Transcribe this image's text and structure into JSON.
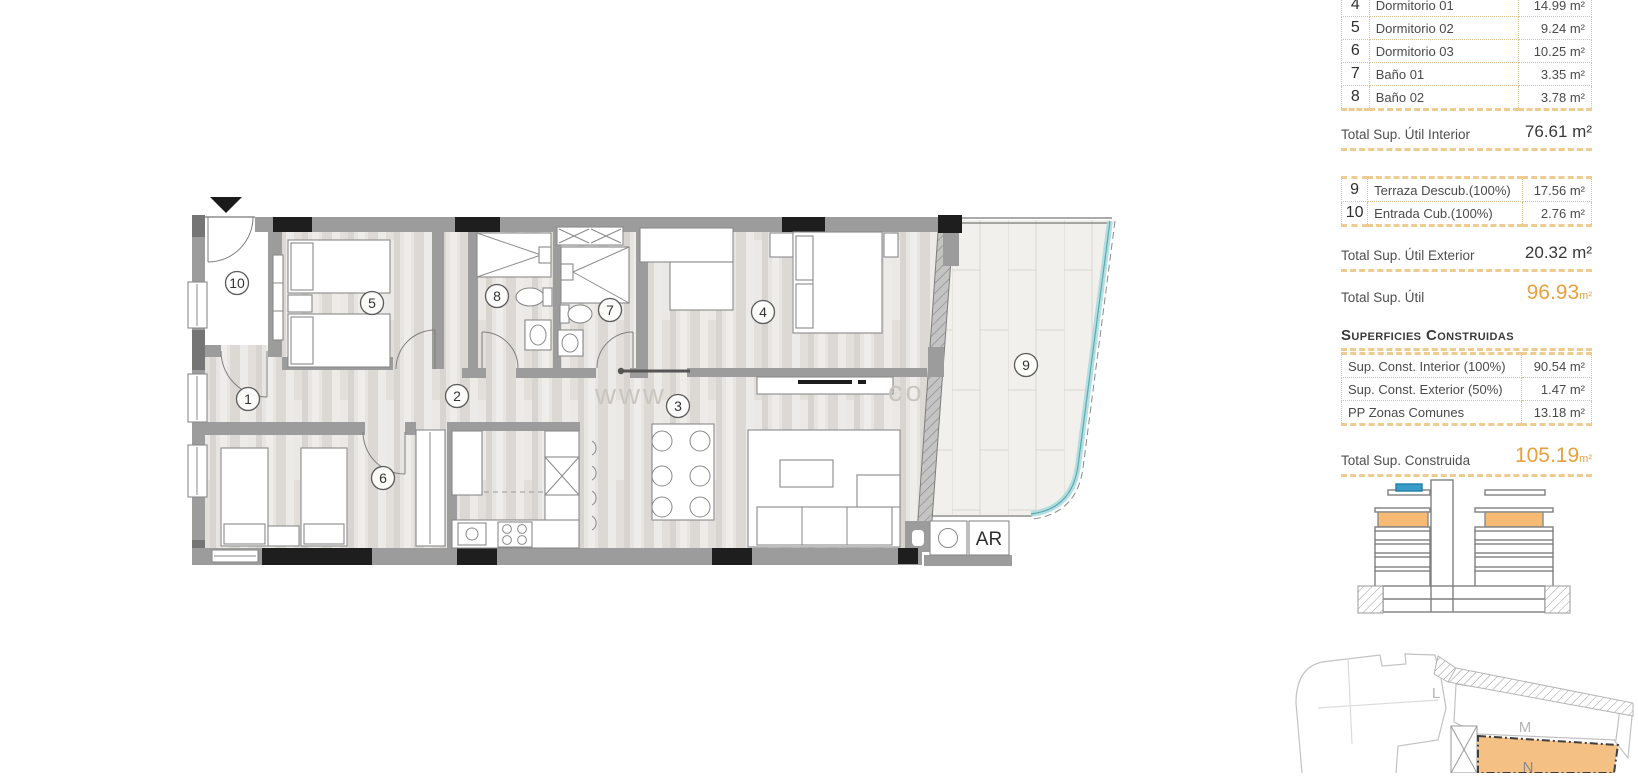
{
  "colors": {
    "accent_orange": "#E8A13E",
    "dash_orange": "#EECB91",
    "table_border": "#DDC28F",
    "wall_gray": "#9C9C9C",
    "pillar_black": "#1E1E1E",
    "glass_teal": "#A8DADE",
    "highlight_orange_fill": "#F5C083",
    "elevation_blue": "#3A9CC9"
  },
  "panel": {
    "interior_rooms": [
      {
        "num": "4",
        "label": "Dormitorio 01",
        "value": "14.99 m²"
      },
      {
        "num": "5",
        "label": "Dormitorio 02",
        "value": "9.24 m²"
      },
      {
        "num": "6",
        "label": "Dormitorio 03",
        "value": "10.25 m²"
      },
      {
        "num": "7",
        "label": "Baño 01",
        "value": "3.35 m²"
      },
      {
        "num": "8",
        "label": "Baño 02",
        "value": "3.78 m²"
      }
    ],
    "total_interior": {
      "label": "Total Sup. Útil Interior",
      "value": "76.61 m²"
    },
    "exterior_rooms": [
      {
        "num": "9",
        "label": "Terraza Descub.(100%)",
        "value": "17.56 m²"
      },
      {
        "num": "10",
        "label": "Entrada Cub.(100%)",
        "value": "2.76 m²"
      }
    ],
    "total_exterior": {
      "label": "Total Sup. Útil Exterior",
      "value": "20.32 m²"
    },
    "total_util": {
      "label": "Total Sup. Útil",
      "value": "96.93",
      "unit": "m²"
    },
    "constructed_heading": "Superficies Construidas",
    "constructed_rows": [
      {
        "label": "Sup. Const. Interior (100%)",
        "value": "90.54 m²"
      },
      {
        "label": "Sup. Const. Exterior (50%)",
        "value": "1.47 m²"
      },
      {
        "label": "PP Zonas Comunes",
        "value": "13.18 m²"
      }
    ],
    "total_construida": {
      "label": "Total Sup. Construida",
      "value": "105.19",
      "unit": "m²"
    }
  },
  "floorplan": {
    "room_markers": [
      {
        "num": "1",
        "x": 248,
        "y": 399
      },
      {
        "num": "2",
        "x": 457,
        "y": 396
      },
      {
        "num": "3",
        "x": 678,
        "y": 406
      },
      {
        "num": "4",
        "x": 763,
        "y": 312
      },
      {
        "num": "5",
        "x": 372,
        "y": 303
      },
      {
        "num": "6",
        "x": 383,
        "y": 478
      },
      {
        "num": "7",
        "x": 610,
        "y": 310
      },
      {
        "num": "8",
        "x": 497,
        "y": 296
      },
      {
        "num": "9",
        "x": 1026,
        "y": 365
      },
      {
        "num": "10",
        "x": 237,
        "y": 283
      }
    ],
    "ar_unit_label": "AR",
    "watermark_left": "www.",
    "watermark_right": "co"
  },
  "siteplan": {
    "block_l": "L",
    "block_m": "M",
    "block_n": "N"
  }
}
